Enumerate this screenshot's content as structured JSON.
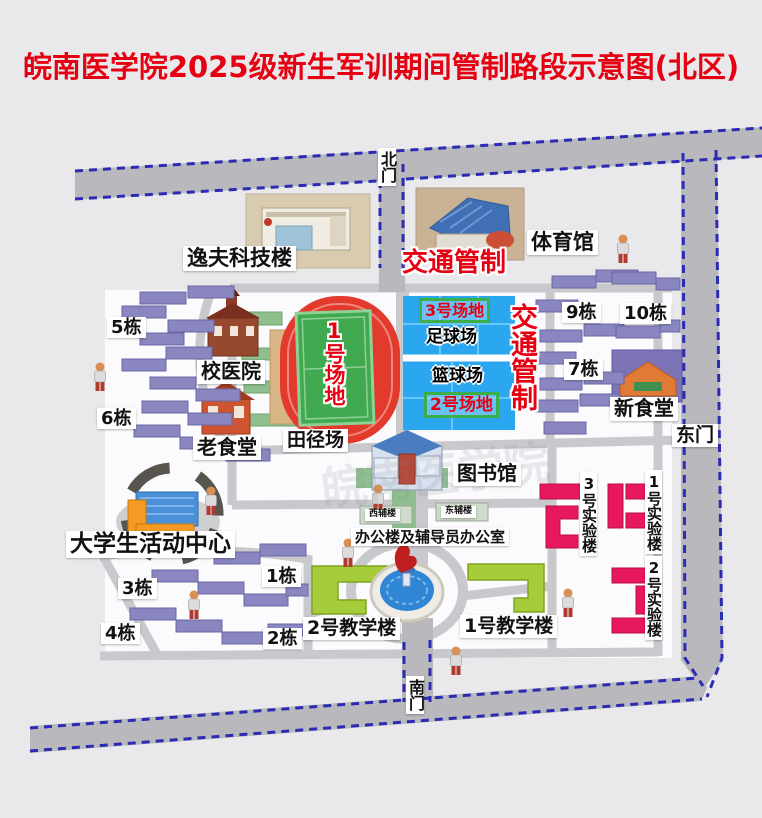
{
  "title": "皖南医学院2025级新生军训期间管制路段示意图(北区)",
  "watermark": "皖南医学院",
  "gates": {
    "north": "北门",
    "south": "南门",
    "east": "东门"
  },
  "traffic_control": {
    "top": "交通管制",
    "side": "交通管制"
  },
  "sports": {
    "track_label": "田径场",
    "field1": "1号场地",
    "field2": "2号场地",
    "field3": "3号场地",
    "football": "足球场",
    "basketball": "篮球场"
  },
  "buildings": {
    "yifu_tech": "逸夫科技楼",
    "gymnasium": "体育馆",
    "school_hospital": "校医院",
    "old_canteen": "老食堂",
    "new_canteen": "新食堂",
    "library": "图书馆",
    "west_annex": "西辅楼",
    "east_annex": "东辅楼",
    "office": "办公楼及辅导员办公室",
    "activity_center": "大学生活动中心",
    "teaching1": "1号教学楼",
    "teaching2": "2号教学楼",
    "lab1": "1号实验楼",
    "lab2": "2号实验楼",
    "lab3": "3号实验楼"
  },
  "dorms": {
    "d1": "1栋",
    "d2": "2栋",
    "d3": "3栋",
    "d4": "4栋",
    "d5": "5栋",
    "d6": "6栋",
    "d7": "7栋",
    "d9": "9栋",
    "d10": "10栋"
  },
  "colors": {
    "title_red": "#e60012",
    "dash_blue": "#2b2bb4",
    "road_gray": "#b9b9bd",
    "court_blue": "#2aa7ee",
    "pitch_green": "#41a94f",
    "track_red": "#e23b2e",
    "dorm_purple": "#8a86c0",
    "teaching_green": "#a6cc39",
    "lab_crimson": "#e7185c",
    "field_box_green": "#3cae4a"
  }
}
